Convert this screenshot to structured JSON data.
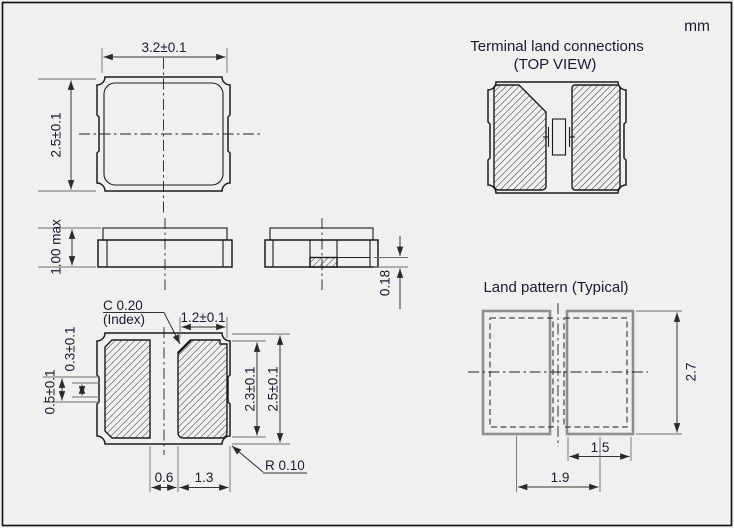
{
  "unit_label": "mm",
  "titles": {
    "terminal_land_line1": "Terminal land connections",
    "terminal_land_line2": "(TOP VIEW)",
    "land_pattern": "Land pattern (Typical)"
  },
  "top_view": {
    "width": "3.2±0.1",
    "height": "2.5±0.1"
  },
  "side_view": {
    "max_height": "1.00 max"
  },
  "end_view": {
    "electrode_thickness": "0.18"
  },
  "bottom_view": {
    "chamfer": "C 0.20",
    "chamfer_note": "(Index)",
    "pad_top_width": "1.2±0.1",
    "castellation_inner": "0.3±0.1",
    "castellation_outer": "0.5±0.1",
    "pad_length": "2.3±0.1",
    "body_length": "2.5±0.1",
    "pad_gap": "0.6",
    "pad_bottom_width": "1.3",
    "corner_radius": "R 0.10"
  },
  "land_pattern": {
    "height": "2.7",
    "pad_width": "1.5",
    "pitch": "1.9"
  }
}
